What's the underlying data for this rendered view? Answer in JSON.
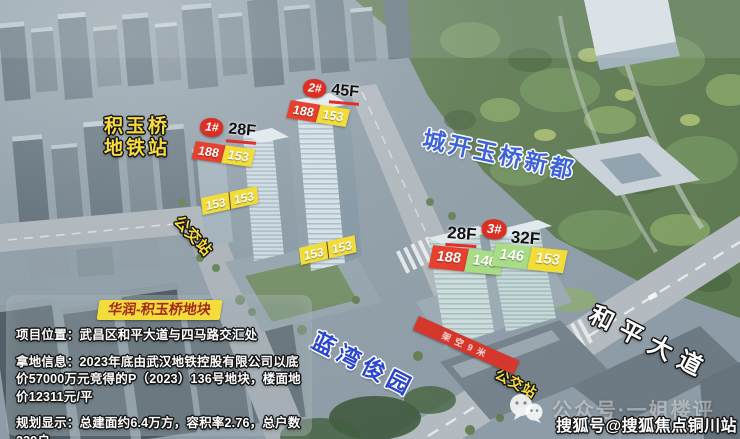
{
  "scene": {
    "metro_station": {
      "line1": "积玉桥",
      "line2": "地铁站"
    },
    "bus_station_left": "公交站",
    "bus_station_right": "公交站",
    "competitor_project": "城开玉桥新都",
    "neighbor_project": "蓝湾俊园",
    "road_name": "和平大道",
    "stilt_banner": "架空9米"
  },
  "towers": [
    {
      "id": "1#",
      "floors": "28F",
      "area_tags": [
        "188",
        "153"
      ]
    },
    {
      "id": "2#",
      "floors": "45F",
      "area_tags": [
        "188",
        "153"
      ]
    },
    {
      "id": "3#",
      "floors_left": "28F",
      "floors_right": "32F",
      "area_tags_left": [
        "188",
        "146"
      ],
      "area_tags_right": [
        "146",
        "153"
      ]
    }
  ],
  "unit_area_pairs": [
    [
      "153",
      "153"
    ],
    [
      "153",
      "153"
    ]
  ],
  "info_panel": {
    "title": "华润-积玉桥地块",
    "lines": [
      {
        "label": "项目位置：",
        "text": "武昌区和平大道与四马路交汇处"
      },
      {
        "label": "拿地信息：",
        "text": "2023年底由武汉地铁控股有限公司以底价57000万元竞得的P（2023）136号地块，楼面地价12311元/平"
      },
      {
        "label": "规划显示：",
        "text": "总建面约6.4万方，容积率2.76，总户数239户"
      }
    ]
  },
  "watermarks": {
    "wechat_account": "公众号·一姐楼评",
    "sohu_account": "搜狐号@搜狐焦点铜川站"
  },
  "colors": {
    "badge_red": "#dc2f23",
    "tag_red": "#e8402e",
    "tag_yellow": "#f2dc3a",
    "tag_green": "#a8dd85",
    "station_yellow": "#f8dc3f",
    "project_blue": "#3e63d8",
    "neighbor_blue": "#2b46cc",
    "banner_red": "#d5372c"
  }
}
